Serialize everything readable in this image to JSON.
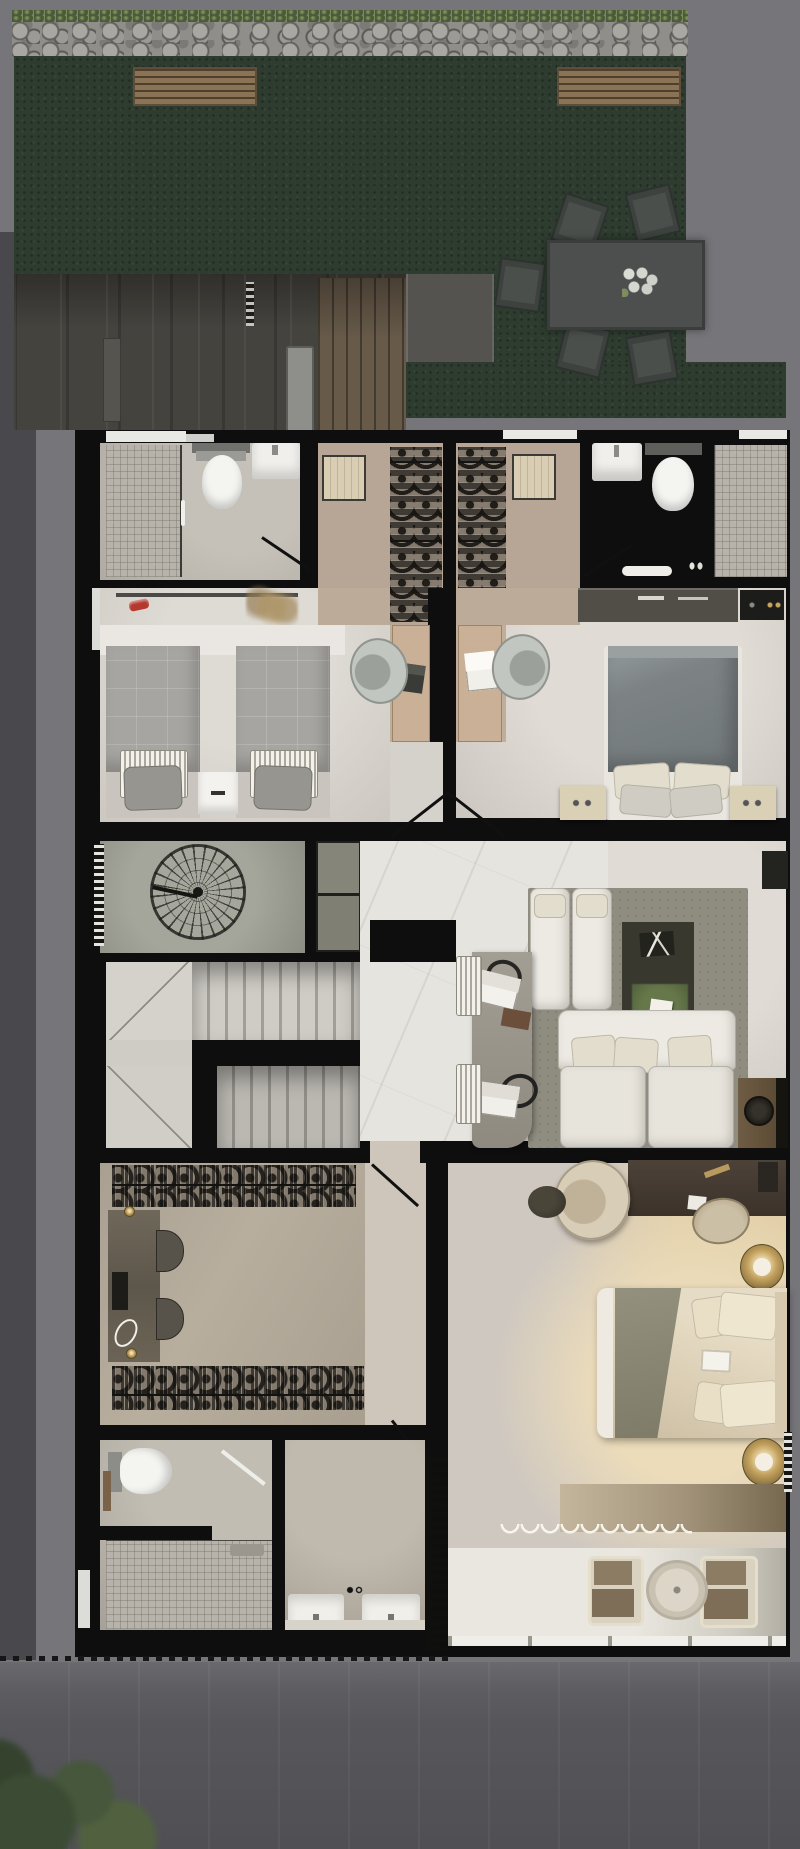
{
  "scene": {
    "title": "3D rendered residential floor plan, top-down view, dusk lighting",
    "canvas": {
      "width": 800,
      "height": 1849
    },
    "text_visible_in_image": "none"
  },
  "palette": {
    "background_gray": "#77777b",
    "background_dark_strip": "#49494d",
    "pavement": "#5e5e62",
    "stone_wall": "#8f8e8a",
    "moss_green": "#5c6a4a",
    "lawn_green": "#2e3c30",
    "deck_shadow": "#45433e",
    "wall_black": "#0e0e0e",
    "floor_light": "#d7d3cd",
    "floor_warm_tan": "#bfae9a",
    "marble_white": "#e6e4df",
    "mosaic_tile": "#b7b3aa",
    "sofa_white": "#edeae3",
    "rug_olive": "#8f8d80",
    "duvet_slate": "#7d8385",
    "duvet_gray": "#a7a5a1",
    "bed_cream": "#ddd1ba",
    "throw_olive": "#8a8876",
    "desk_dark_wood": "#463c33",
    "cabinet_wood": "#6b5942",
    "gold_accent": "#c4a25f",
    "outdoor_chair": "#3d423f",
    "balcony_chair_brown": "#8d7c64",
    "red_accent": "#b5392e",
    "artwork_green": "#55663f"
  },
  "rooms": {
    "garden": "Garden lawn with stone boundary wall",
    "deck": "Shaded deck / terrace below garden",
    "bathroom1": "Bathroom 1 (shower, toilet, sink)",
    "closet1": "Walk-in closet 1 with ottoman",
    "closet2": "Walk-in closet 2 with ottoman",
    "bathroom2": "Bathroom 2 (sink, toilet, shower)",
    "kids_bedroom": "Bedroom with two single beds and desk",
    "bedroom2": "Bedroom with slate double bed and desk",
    "spiral_room": "Spiral staircase room",
    "hallway": "Marble hallway",
    "staircase": "U-shaped main staircase",
    "lounge": "Family lounge with white sectional sofa",
    "master_closet": "Master walk-in closet with vanity",
    "master_hall": "Master suite entry hall",
    "master_bedroom": "Master bedroom",
    "master_bathroom": "Master bathroom with walk-in shower",
    "vanity_room": "Double-sink vanity room",
    "balcony": "Balcony with lounge chairs and round table",
    "street": "Street pavement with trees"
  },
  "furniture": {
    "outdoor": [
      "stone wall",
      "2 wooden benches",
      "rectangular dining table",
      "5 outdoor chairs",
      "plate set on table"
    ],
    "bathroom1": [
      "mosaic shower",
      "toilet",
      "wash basin",
      "door swing"
    ],
    "closets_top": [
      "2 beige ottomans",
      "4 hanging clothes rails"
    ],
    "bathroom2": [
      "wash basin",
      "toilet",
      "mosaic shower",
      "bath mat",
      "door swing"
    ],
    "kids_bedroom": [
      "2 single beds gray duvets",
      "shared nightstand",
      "wall shelf",
      "red toy car",
      "dried plant",
      "wood desk with laptop",
      "desk chair"
    ],
    "bedroom2": [
      "double bed slate duvet",
      "4 pillows",
      "2 beige nightstands",
      "low dresser",
      "wall shelf",
      "wood desk with laptop",
      "desk chair"
    ],
    "circulation": [
      "spiral staircase",
      "U-shaped staircase with landings",
      "2 olive closet panels",
      "radiator ticks"
    ],
    "lounge": [
      "2 white chaise modules",
      "3-seat white sectional with pillows",
      "dark media panel with green artwork",
      "stone console table",
      "2 laptops",
      "2 headphones",
      "tablet",
      "2 striped benches",
      "wood cabinet with round speaker",
      "wall fireplace box"
    ],
    "master_closet": [
      "2 long hanging rails",
      "vanity counter",
      "2 half-round stools",
      "hand mirror",
      "2 brass lamps"
    ],
    "master_bedroom": [
      "king bed cream duvet with olive throw",
      "4 cream pillows",
      "breakfast tray",
      "2 round gold floor lamps",
      "dark wood desk",
      "desk chair",
      "round lounge chair",
      "round side table",
      "long dresser",
      "sheer wavy curtain",
      "louvered screen"
    ],
    "master_bathroom": [
      "toilet",
      "towel rail",
      "large mosaic walk-in shower",
      "white door leaf"
    ],
    "vanity_room": [
      "2 white sinks",
      "counter edge"
    ],
    "balcony": [
      "2 brown lounge chairs",
      "round table",
      "slab edge with drain ticks"
    ],
    "street": [
      "dashed property line",
      "pavement",
      "2 tree canopies"
    ]
  },
  "counts": {
    "bedrooms": 3,
    "bathrooms": 3,
    "staircases": 2,
    "outdoor_chairs": 5,
    "balcony_chairs": 2
  }
}
